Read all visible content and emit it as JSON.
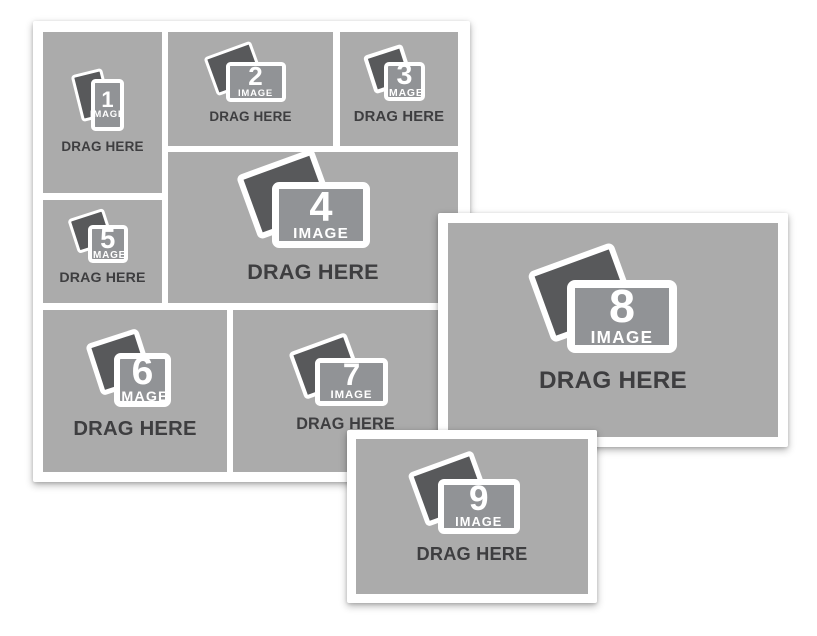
{
  "window": {
    "background": "#FFFFFF"
  },
  "colors": {
    "card_bg": "#FFFFFF",
    "cell_bg": "#ABABAB",
    "photo_back": "#58595B",
    "photo_front": "#919396",
    "drag_label_color": "#3E3E40",
    "image_label_color": "#FFFFFF"
  },
  "panels": {
    "collage_grid_cell_count": "7",
    "standalone_cards": "2"
  },
  "cells": [
    {
      "number": "1",
      "image_label": "IMAGE",
      "drag_label": "DRAG HERE",
      "icon": "photo-stack-icon",
      "orientation": "portrait"
    },
    {
      "number": "2",
      "image_label": "IMAGE",
      "drag_label": "DRAG HERE",
      "icon": "photo-stack-icon",
      "orientation": "landscape"
    },
    {
      "number": "3",
      "image_label": "IMAGE",
      "drag_label": "DRAG HERE",
      "icon": "photo-stack-icon",
      "orientation": "square"
    },
    {
      "number": "4",
      "image_label": "IMAGE",
      "drag_label": "DRAG HERE",
      "icon": "photo-stack-icon",
      "orientation": "landscape"
    },
    {
      "number": "5",
      "image_label": "IMAGE",
      "drag_label": "DRAG HERE",
      "icon": "photo-stack-icon",
      "orientation": "square"
    },
    {
      "number": "6",
      "image_label": "IMAGE",
      "drag_label": "DRAG HERE",
      "icon": "photo-stack-icon",
      "orientation": "square"
    },
    {
      "number": "7",
      "image_label": "IMAGE",
      "drag_label": "DRAG HERE",
      "icon": "photo-stack-icon",
      "orientation": "landscape"
    },
    {
      "number": "8",
      "image_label": "IMAGE",
      "drag_label": "DRAG HERE",
      "icon": "photo-stack-icon",
      "orientation": "landscape"
    },
    {
      "number": "9",
      "image_label": "IMAGE",
      "drag_label": "DRAG HERE",
      "icon": "photo-stack-icon",
      "orientation": "landscape"
    }
  ]
}
